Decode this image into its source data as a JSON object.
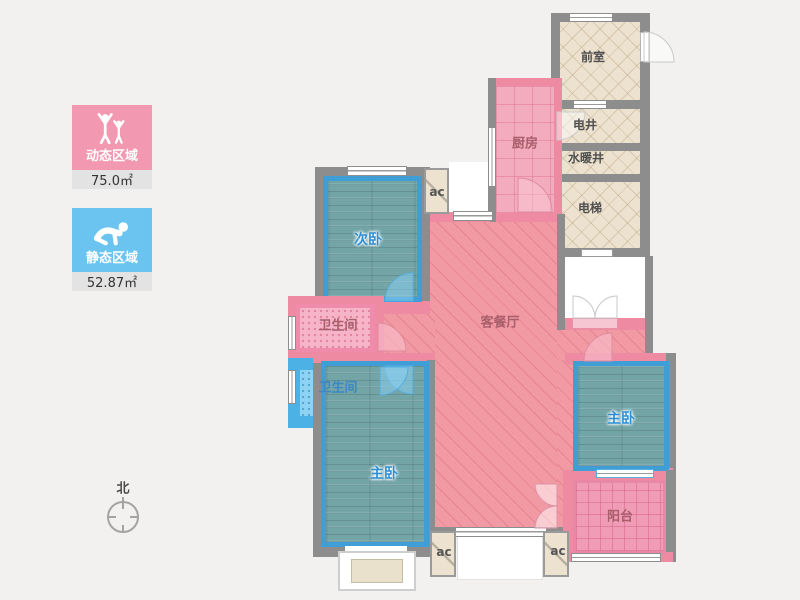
{
  "legend": {
    "dynamic": {
      "label": "动态区域",
      "area": "75.0㎡",
      "color": "#f298b0",
      "icon": "people-standing-icon"
    },
    "static": {
      "label": "静态区域",
      "area": "52.87㎡",
      "color": "#6ac4ef",
      "icon": "person-crawling-icon"
    }
  },
  "compass": {
    "label": "北"
  },
  "rooms": [
    {
      "id": "front-room",
      "label": "前室"
    },
    {
      "id": "electric-shaft",
      "label": "电井"
    },
    {
      "id": "plumbing-shaft",
      "label": "水暖井"
    },
    {
      "id": "elevator",
      "label": "电梯"
    },
    {
      "id": "kitchen",
      "label": "厨房"
    },
    {
      "id": "second-bedroom",
      "label": "次卧"
    },
    {
      "id": "living-dining",
      "label": "客餐厅"
    },
    {
      "id": "bathroom-1",
      "label": "卫生间"
    },
    {
      "id": "bathroom-2",
      "label": "卫生间"
    },
    {
      "id": "master-bedroom-left",
      "label": "主卧"
    },
    {
      "id": "master-bedroom-right",
      "label": "主卧"
    },
    {
      "id": "balcony",
      "label": "阳台"
    }
  ],
  "ac_units": [
    {
      "label": "ac"
    },
    {
      "label": "ac"
    },
    {
      "label": "ac"
    }
  ],
  "colors": {
    "wall_gray": "#8d8d8d",
    "wall_pink": "#ee8ba2",
    "room_pink": "#f29aa3",
    "room_teal": "#73a5a7",
    "room_beige": "#ece2cf",
    "bath_blue": "#8ed3f4",
    "border_blue": "#3f9ed6",
    "background": "#f2f1ef"
  }
}
